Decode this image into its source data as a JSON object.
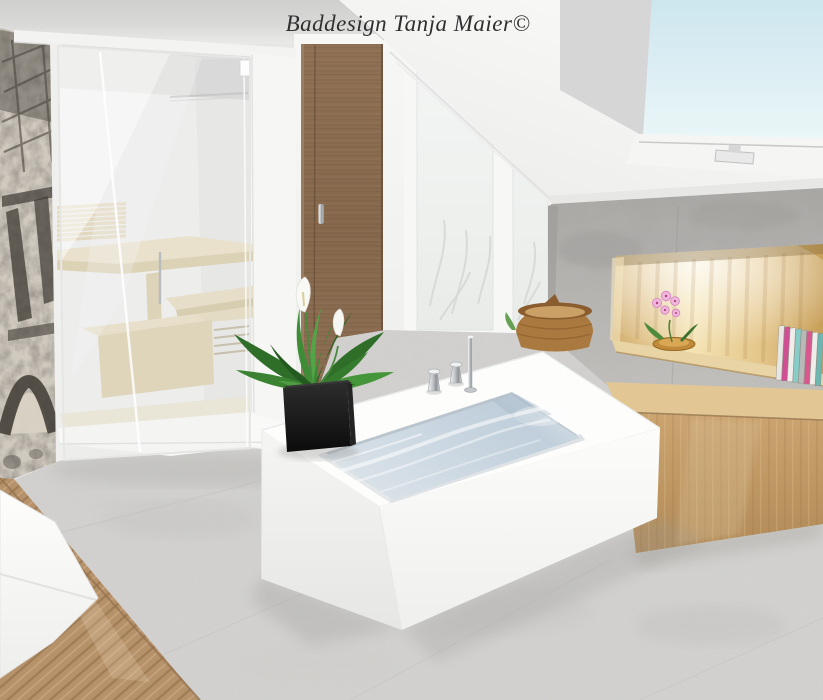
{
  "watermark": {
    "text": "Baddesign Tanja Maier©"
  },
  "scene": {
    "setting": "3D interior rendering of an attic bathroom",
    "objects": [
      "glass-front sauna cabin with pale wood benches",
      "Eiffel Tower photo wallpaper wall",
      "wooden sliding door",
      "tall window with foggy winter view",
      "white sloped attic ceiling",
      "roof skylight with blue sky",
      "concrete feature wall",
      "illuminated wood-lined wall niche",
      "pink orchid in wooden bowl",
      "row of books in niche",
      "long wooden bench block",
      "wicker basket",
      "freestanding white bathtub filled with water",
      "deck-mounted chrome faucet with two handles",
      "peace lily plant in black cube planter",
      "white basin on wooden counter",
      "light gray concrete floor"
    ]
  },
  "palette": {
    "sky": "#d9edf3",
    "window_glass": "#f1f3f2",
    "concrete_wall": "#b3b1ae",
    "niche_wood": "#e8cd93",
    "bench_wood": "#c09a66",
    "door_wood": "#8a6c50",
    "sauna_wood": "#e7ddc2",
    "floor": "#d3d2d0",
    "tub_white": "#fafaf9",
    "water": "#ccd8e1",
    "plant_green": "#3a8231",
    "planter_black": "#161616",
    "basket_wicker": "#a9793f",
    "orchid_pink": "#eeb5da",
    "wallpaper_gray": "#cfc9be"
  },
  "niche": {
    "books": [
      "#e8e6e3",
      "#cf4f92",
      "#f0eeeb",
      "#87ccc6",
      "#b9b9b7",
      "#d9578f",
      "#efede9",
      "#6fb5b0"
    ]
  }
}
